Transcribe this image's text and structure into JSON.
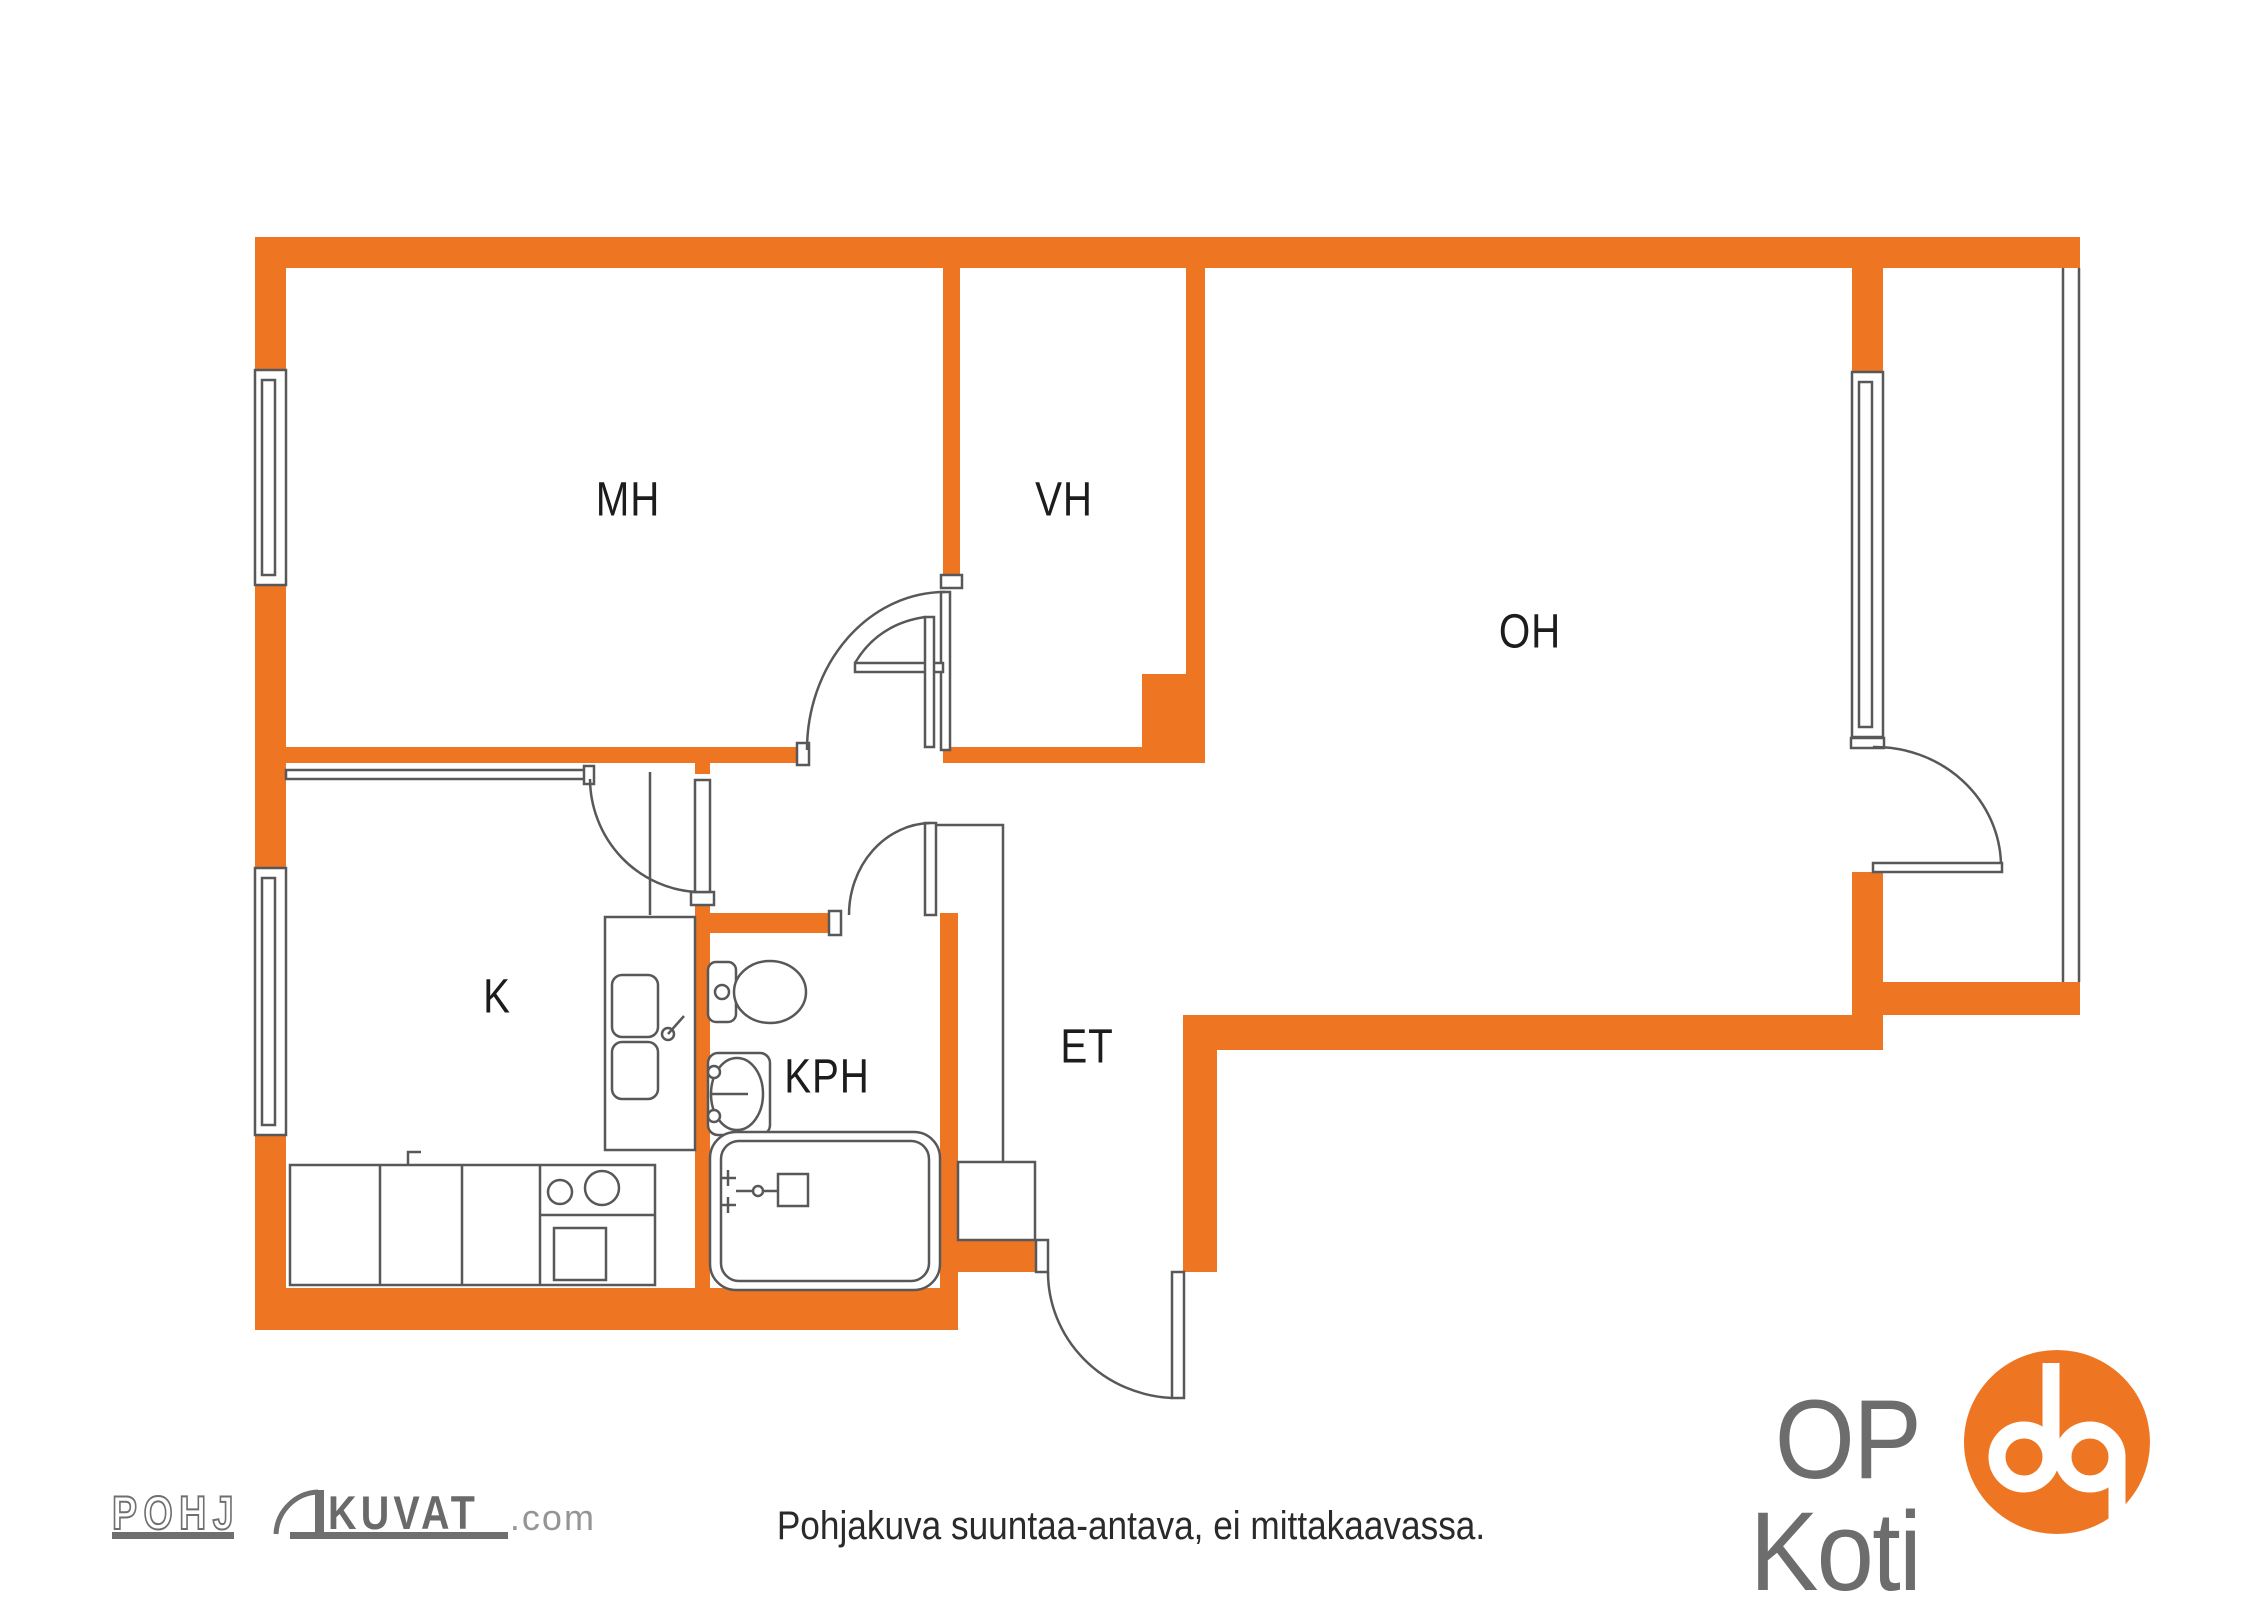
{
  "title": "Apartment floor plan",
  "rooms": [
    {
      "id": "mh",
      "label": "MH"
    },
    {
      "id": "vh",
      "label": "VH"
    },
    {
      "id": "oh",
      "label": "OH"
    },
    {
      "id": "k",
      "label": "K"
    },
    {
      "id": "kph",
      "label": "KPH"
    },
    {
      "id": "et",
      "label": "ET"
    }
  ],
  "caption": "Pohjakuva suuntaa-antava, ei mittakaavassa.",
  "branding": {
    "pohjakuvat": {
      "prefix": "POHJ",
      "main": "KUVAT",
      "suffix": ".com"
    },
    "op_koti": "OP Koti"
  },
  "colors": {
    "wall_orange": "#EE7623",
    "line_gray": "#58585A",
    "logo_gray": "#6F6F6F",
    "text_dark": "#1C1C1C"
  },
  "icons": {
    "door_arc": "quarter-circle door swing symbol",
    "op_logo": "orange circle with white op monogram"
  }
}
